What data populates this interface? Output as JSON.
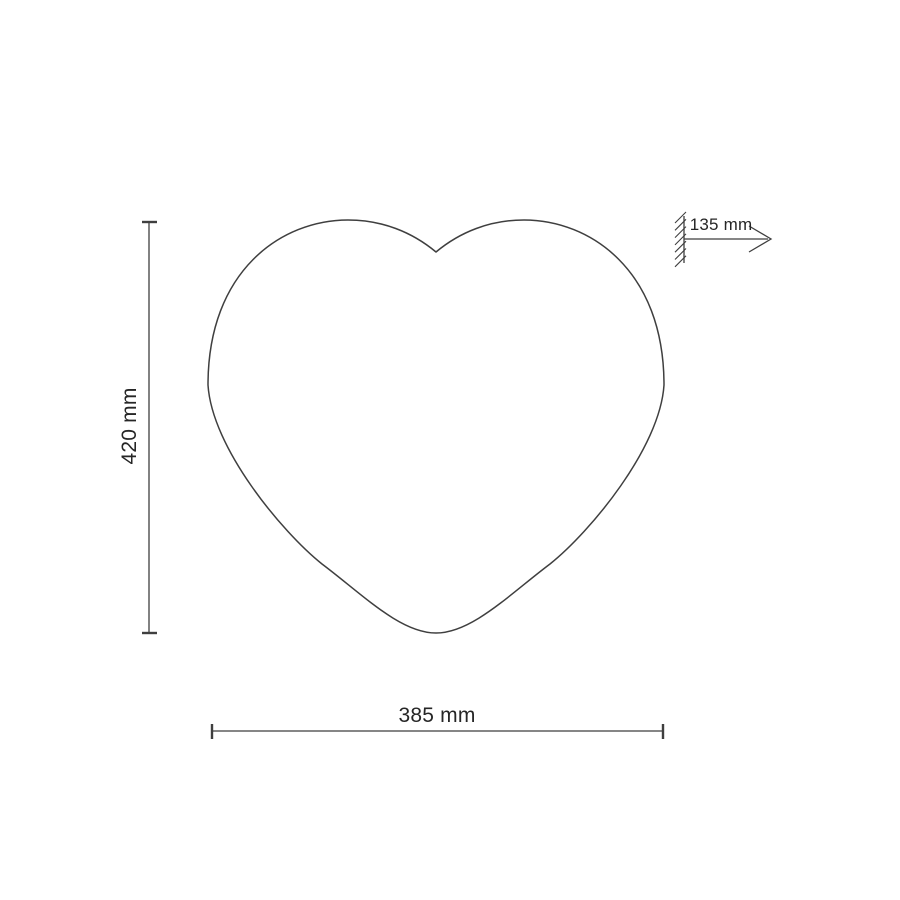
{
  "page": {
    "background": "#ffffff",
    "line_color": "#3f3f3f",
    "text_color": "#262626"
  },
  "drawing": {
    "kind": "technical dimension diagram",
    "subject": "heart-shaped outline with wall-mount depth callout",
    "dimensions": {
      "height": {
        "label": "420 mm",
        "value": 420,
        "unit": "mm",
        "orientation": "vertical"
      },
      "width": {
        "label": "385 mm",
        "value": 385,
        "unit": "mm",
        "orientation": "horizontal"
      },
      "depth": {
        "label": "135 mm",
        "value": 135,
        "unit": "mm",
        "orientation": "horizontal"
      }
    }
  }
}
